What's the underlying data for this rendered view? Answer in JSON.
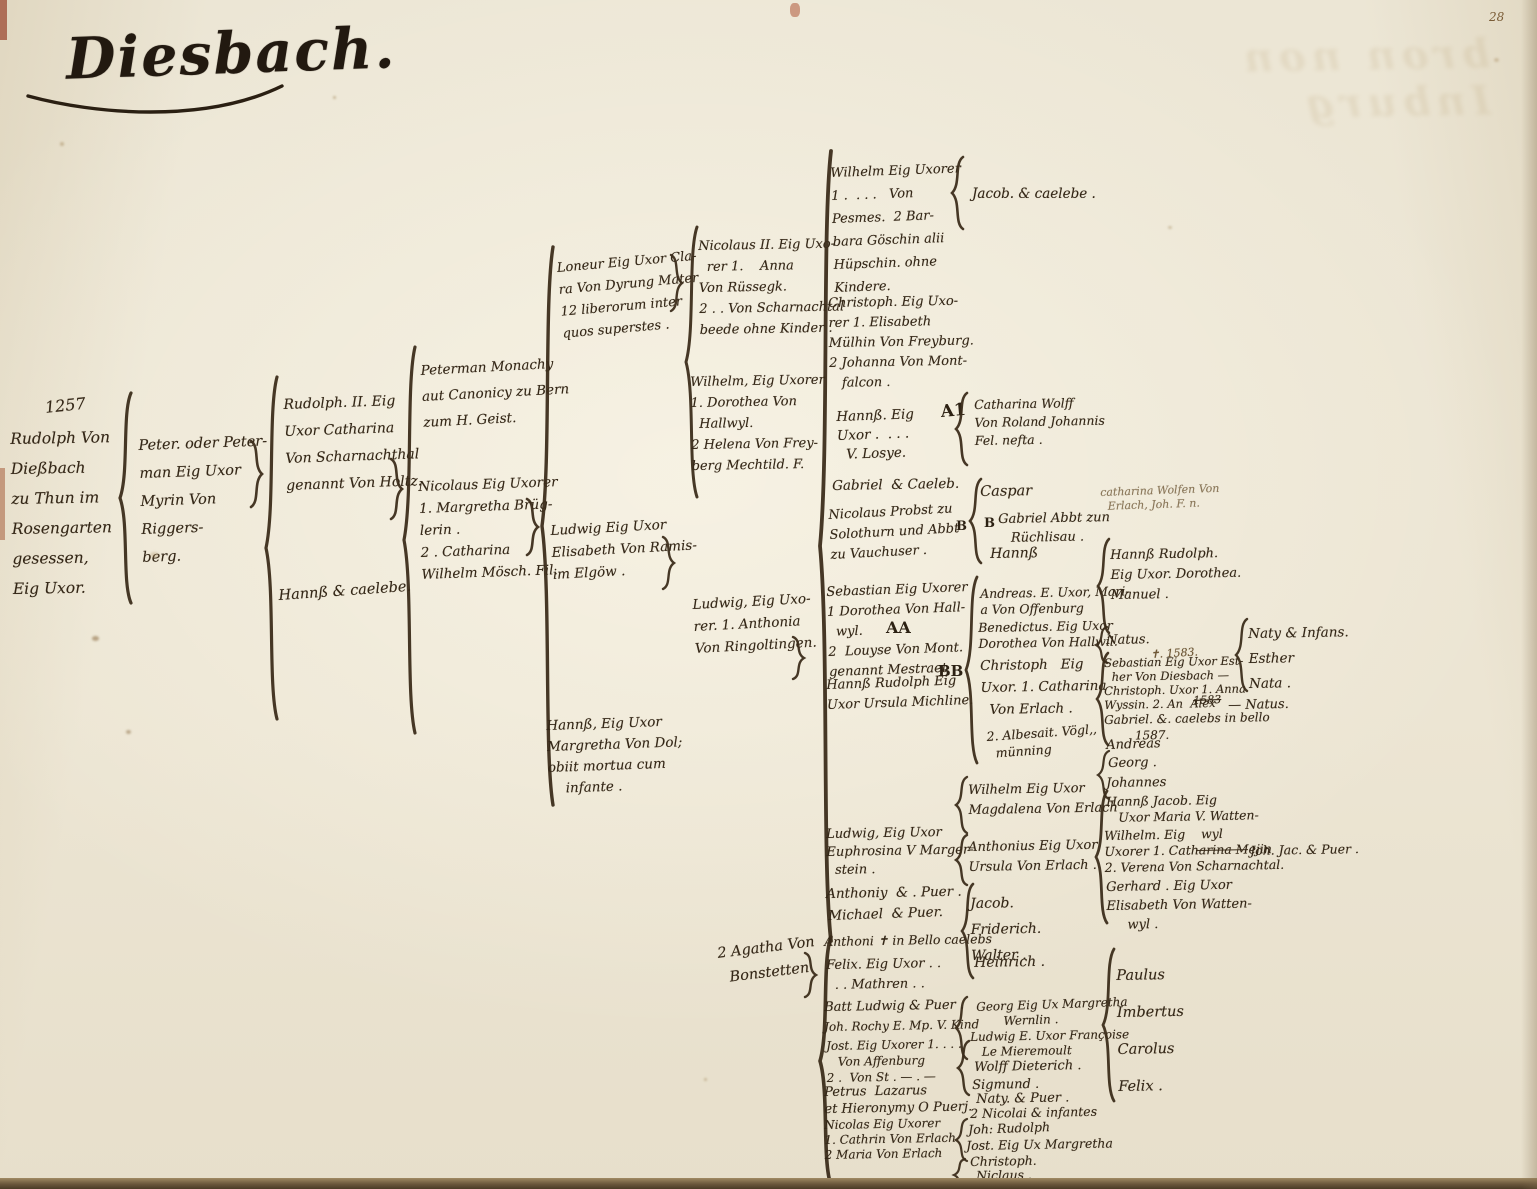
{
  "page": {
    "title": "Diesbach.",
    "page_number": "28",
    "show_through_text": "bron non Inburg"
  },
  "marks": {
    "a1": "A1",
    "aa": "AA",
    "bb": "BB",
    "b_probst": "B",
    "b_gabriel": "B",
    "strike_year": "1583"
  },
  "tree": {
    "g1_date": "1257",
    "g1_rudolph": "Rudolph Von\nDießbach\nzu Thun im\nRosengarten\ngesessen,\nEig Uxor.",
    "g2_peterman": "Peter. oder Peter-\nman Eig Uxor\nMyrin Von Riggers-\nberg.",
    "g3_rudolph2": "Rudolph. II. Eig\nUxor Catharina\nVon Scharnachthal\ngenannt Von Holtz.",
    "g3_hanns": "Hannß & caelebe.",
    "g4_monachy": "Peterman Monachy\naut Canonicy zu Bern\nzum H. Geist.",
    "g4_nicolaus": "Nicolaus Eig Uxorer\n1. Margretha Brüg-\nlerin .\n2 . Catharina\nWilhelm Mösch. Fil.",
    "g5_loneur": "Loneur Eig Uxor Cla-\nra Von Dyrung Mater\n12 liberorum inter\nquos superstes .",
    "g5_ludwig": "Ludwig Eig Uxor\nElisabeth Von Ramis-\nim Elgöw .",
    "g5_hanns": "Hannß, Eig Uxor\nMargretha Von Dol;\nobiit mortua cum\n    infante .",
    "g6_nicolaus2": "Nicolaus II. Eig Uxo-\n  rer 1.    Anna\nVon Rüssegk.\n2 . . Von Scharnachtal\nbeede ohne Kinder .",
    "g6_wilhelm": "Wilhelm, Eig Uxorer\n1. Dorothea Von\n  Hallwyl.\n2 Helena Von Frey-\nberg Mechtild. F.",
    "g6_ludwig": "Ludwig, Eig Uxo-\nrer. 1. Anthonia\nVon Ringoltingen.",
    "g6_agatha": "2 Agatha Von\n  Bonstetten",
    "c7_wilhelm": "Wilhelm Eig Uxorer\n1 .  . . .   Von\nPesmes.  2 Bar-\nbara Göschin alii\nHüpschin. ohne Kindere.",
    "c7_christoph": "Christoph. Eig Uxo-\nrer 1. Elisabeth\nMülhin Von Freyburg.\n2 Johanna Von Mont-\n   falcon .",
    "c7_hanns": "Hannß. Eig\nUxor .  . . .\n  V. Losye.",
    "c7_gabriel": "Gabriel  & Caeleb.",
    "c7_probst": "Nicolaus Probst zu\nSolothurn und Abbt\nzu Vauchuser .",
    "c7_sebastian": "Sebastian Eig Uxorer\n1 Dorothea Von Hall-\n  wyl.\n2  Louyse Von Mont.\ngenannt Mestraet",
    "c7_hanns_rudolph": "Hannß Rudolph Eig\nUxor Ursula Michline.",
    "c7_ludwig_euphrosina": "Ludwig, Eig Uxor\nEuphrosina V Marger-\n  stein .",
    "c7_anthoniy": "Anthoniy  & . Puer .",
    "c7_michael": "Michael  & Puer.",
    "c7_anthoni_bello": "Anthoni ✝ in Bello caelebs",
    "c7_felix": "Felix. Eig Uxor . .\n  . . Mathren . .",
    "c7_batt_ludwig": "Batt Ludwig & Puer .",
    "c7_joh_rochy": "Joh. Rochy E. Mp. V. Kind",
    "c7_jost": "Jost. Eig Uxorer 1. . . .\n   Von Affenburg\n2 .  Von St . — . —",
    "c7_petrus": "Petrus  Lazarus\net Hieronymy O Puerj.",
    "c7_nicolas": "Nicolas Eig Uxorer\n1. Cathrin Von Erlach\n2 Maria Von Erlach",
    "c8_jacob": "Jacob. & caelebe .",
    "c8_catharina_wolff": "Catharina Wolff\nVon Roland Johannis\nFel. nefta .",
    "c8_caspar": "Caspar",
    "c8_gabriel_abbt": "Gabriel Abbt zun\n   Rüchlisau .",
    "c8_hanns": "Hannß",
    "c8_andreas": "Andreas. E. Uxor, Mari-\na Von Offenburg",
    "c8_benedictus": "Benedictus. Eig Uxor\nDorothea Von Hallwil.",
    "c8_christoph": "Christoph   Eig\nUxor. 1. Catharina\n  Von Erlach .",
    "c8_albesait": "2. Albesait. Vögl,,\n  münning",
    "c8_wilhelm_magdalena": "Wilhelm Eig Uxor\nMagdalena Von Erlach",
    "c8_anthonius": "Anthonius Eig Uxor\nUrsula Von Erlach .",
    "c8_jacob_friderich_walter": "Jacob.\nFriderich.\nWalter .",
    "c8_heinrich": "Heinrich .",
    "c8_georg": "Georg Eig Ux Margretha\n       Wernlin .",
    "c8_ludwig_francoise": "Ludwig E. Uxor Françoise\n   Le Mieremoult",
    "c8_wolff_dieterich": "Wolff Dieterich .",
    "c8_sigmund": "Sigmund .",
    "c8_naty": "Naty. & Puer .",
    "c8_nicolai": "2 Nicolai & infantes",
    "c8_joh_rudolph": "Joh: Rudolph",
    "c8_jost": "Jost. Eig Ux Margretha",
    "c8_christoph2": "Christoph.",
    "c8_niclaus": "Niclaus .",
    "c9_hanns_rudolph": "Hannß Rudolph.\nEig Uxor. Dorothea.\nManuel .",
    "c9_natus": "Natus.",
    "c9_natus_date": "✝. 1583.",
    "c9_sebastian": "Sebastian Eig Uxor Est-\n  her Von Diesbach —",
    "c9_christoph_wyssin": "Christoph. Uxor 1. Anna\nWyssin. 2. An  Alex",
    "c9_gabriel_caelebs": "Gabriel. &. caelebs in bello\n        1587.",
    "c9_andreas": "Andreas",
    "c9_georg": "Georg .",
    "c9_johannes": "Johannes",
    "c9_hanns_jacob": "Hannß Jacob. Eig\n   Uxor Maria V. Watten-",
    "c9_wilhelm": "Wilhelm. Eig    wyl\nUxorer 1. Catharina Mejin\n2. Verena Von Scharnachtal.",
    "c9_gerhard": "Gerhard . Eig Uxor\nElisabeth Von Watten-\n     wyl .",
    "c9_paulus_group": "Paulus\nImbertus\nCarolus\nFelix .",
    "c10_naty_infans": "Naty & Infans.\nEsther\nNata .",
    "c10_natus": "— Natus.",
    "c10_joh_jac": "Joh. Jac. & Puer .",
    "faint_catharina": "catharina Wolfen Von\n  Erlach, Joh. F. n."
  }
}
